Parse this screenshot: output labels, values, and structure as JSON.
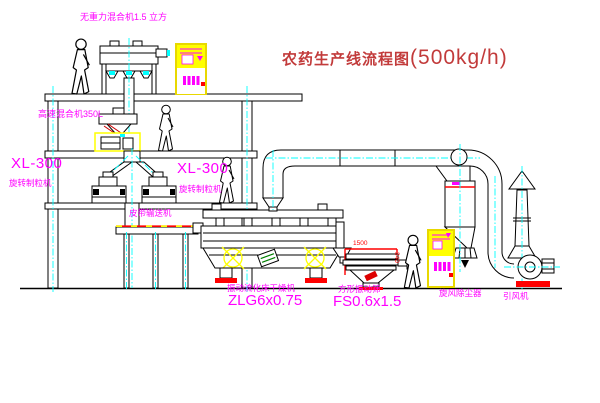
{
  "title": {
    "name_cn": "农药生产线流程图",
    "capacity": "(500kg/h)"
  },
  "equipment_labels": {
    "gravity_free_mixer": "无重力混合机1.5 立方",
    "high_speed_mixer": "高速混合机350L",
    "granulator_left": {
      "model": "XL-300",
      "name": "旋转制粒机"
    },
    "granulator_mid": {
      "model": "XL-300",
      "name": "旋转制粒机"
    },
    "belt_conveyor": "皮带输送机",
    "fluid_bed_dryer": {
      "name": "振动流化床干燥机",
      "model": "ZLG6x0.75"
    },
    "square_sieve": {
      "name": "方形振动筛",
      "model": "FS0.6x1.5"
    },
    "cyclone": "旋风除尘器",
    "induced_draft_fan": "引风机"
  },
  "dimensions": {
    "sieve_length": "1500",
    "sieve_height": "340"
  },
  "colors": {
    "label_magenta": "#ff00ff",
    "title_red": "#c23b3b",
    "cabinet_yellow": "#ffff00",
    "centerline_cyan": "#00ffff",
    "accent_red": "#ff0000",
    "line_black": "#000000"
  }
}
